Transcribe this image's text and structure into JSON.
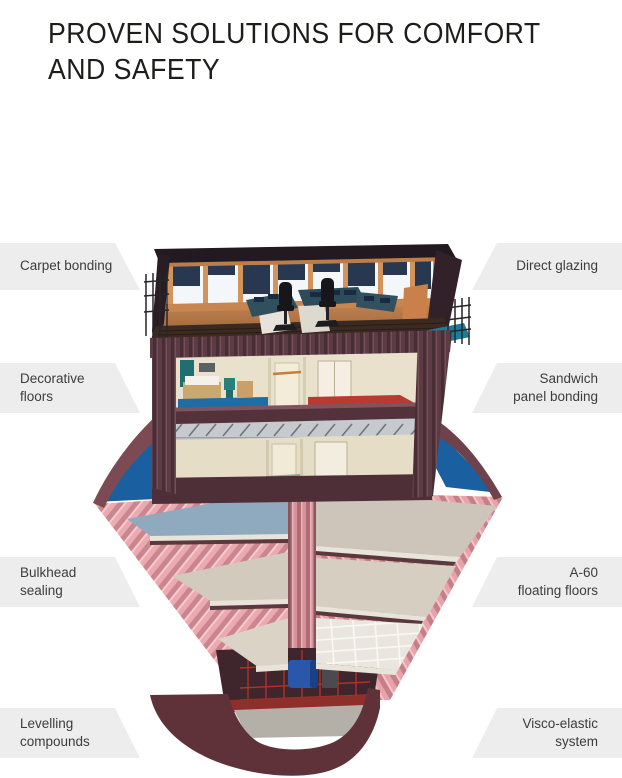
{
  "page": {
    "background": "#ffffff"
  },
  "title": {
    "lines": [
      "PROVEN SOLUTIONS FOR COMFORT",
      "AND SAFETY"
    ],
    "color": "#1d1d1b"
  },
  "callouts": {
    "style": {
      "background": "#ededee",
      "text_color": "#3c3c3b"
    },
    "left": [
      {
        "lines": [
          "Carpet bonding",
          ""
        ]
      },
      {
        "lines": [
          "Decorative",
          "floors"
        ]
      },
      {
        "lines": [
          "Bulkhead",
          "sealing"
        ]
      },
      {
        "lines": [
          "Levelling",
          "compounds"
        ]
      }
    ],
    "right": [
      {
        "lines": [
          "Direct glazing",
          ""
        ]
      },
      {
        "lines": [
          "Sandwich",
          "panel bonding"
        ]
      },
      {
        "lines": [
          "A-60",
          "floating floors"
        ]
      },
      {
        "lines": [
          "Visco-elastic",
          "system"
        ]
      }
    ]
  },
  "illustration": {
    "name": "ship-cross-section-cutaway",
    "description": "3D cutaway of a vessel showing bridge wheelhouse, accommodation decks and hull interior with corrugated bulkheads and engine room",
    "parts": [
      "bridge-wheelhouse",
      "bridge-windows",
      "bridge-consoles",
      "pilot-chairs",
      "railings",
      "accommodation-deck-upper",
      "accommodation-deck-lower",
      "cabin-bed",
      "cabin-chair",
      "corridor",
      "hull-cutaway",
      "corrugated-bulkheads",
      "center-bulkhead",
      "deck-floors",
      "tiled-floor",
      "engine-room",
      "engine",
      "hull-bottom",
      "waterline"
    ],
    "colors": {
      "roof_dark": "#221921",
      "wood_orange": "#d2945c",
      "blind_navy": "#273850",
      "console_teal": "#30505e",
      "bridge_floor_brown": "#3b2a21",
      "exterior_maroon": "#5d3b44",
      "cabin_cream": "#e9e1cb",
      "carpet_blue": "#1f6da5",
      "carpet_red": "#b83a30",
      "corridor_green": "#6fb29b",
      "water_blue": "#1a5f9f",
      "hull_pink": "#eba9b0",
      "hull_pink_shade": "#cb858e",
      "deck_bluegray": "#8fa9be",
      "deck_beige": "#d2cabc",
      "bowl_dark": "#5f3239",
      "engine_blue": "#2b57ab",
      "truss_red": "#b23129",
      "wing_teal": "#1b7d9c"
    }
  }
}
